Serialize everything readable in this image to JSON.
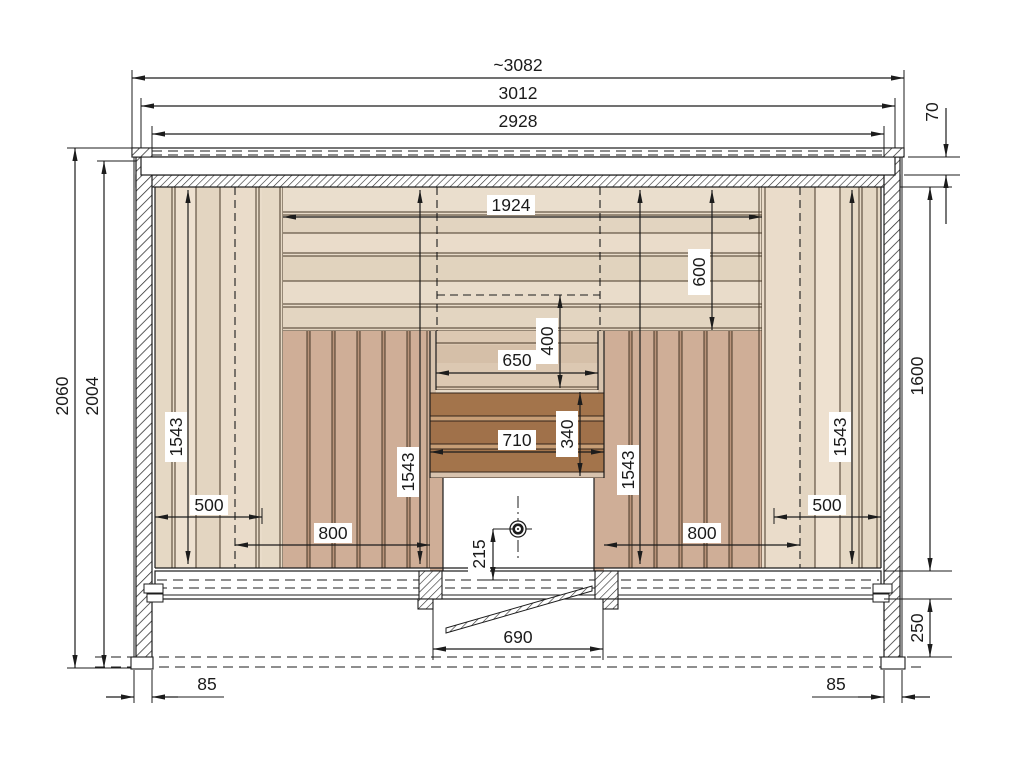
{
  "drawing": {
    "kind": "sauna-front-section-technical-drawing",
    "units": "mm"
  },
  "dim": {
    "overall_width": "~3082",
    "frame_width": "3012",
    "shell_width": "2928",
    "roof_plank_thickness": "70",
    "total_height": "2060",
    "inner_height": "2004",
    "back_panel_width": "1924",
    "upper_panel_height": "600",
    "right_inner_height": "1600",
    "panel_height_left": "1543",
    "panel_height_center_left": "1543",
    "panel_height_center_right": "1543",
    "panel_height_right": "1543",
    "niche_width": "650",
    "niche_top_offset": "400",
    "guard_width": "710",
    "guard_height": "340",
    "seat_depth_left": "500",
    "seat_depth_right": "500",
    "seat_width_left": "800",
    "seat_width_right": "800",
    "drain_center_height": "215",
    "door_opening_width": "690",
    "base_height": "250",
    "wall_thickness_left": "85",
    "wall_thickness_right": "85"
  }
}
